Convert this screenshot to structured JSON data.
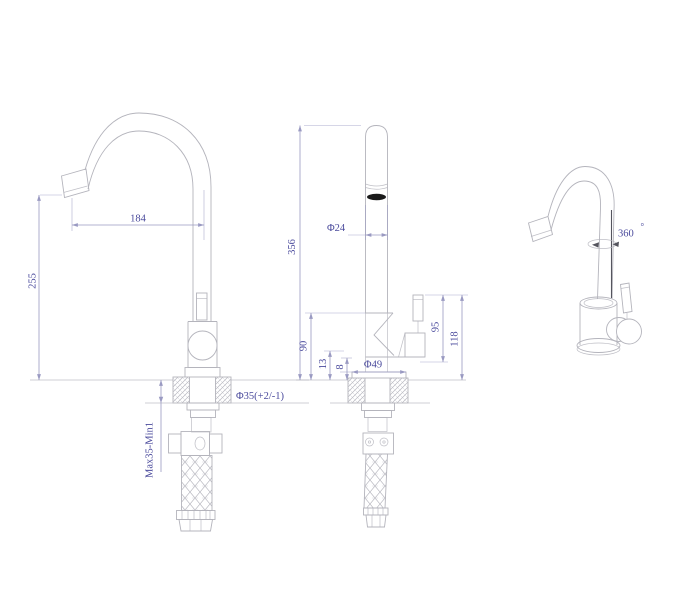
{
  "colors": {
    "background": "#ffffff",
    "geometry_line": "#b4b4bc",
    "dimension_line": "#9a9ac2",
    "dimension_text": "#4a4a9c",
    "dark_accent": "#55555e",
    "aerator_fill": "#1a1a1a"
  },
  "views": {
    "side_view": {
      "dimensions": {
        "spout_reach": "184",
        "spout_height": "255",
        "mounting_thickness_range": "Max35-Min1",
        "hole_diameter": "Φ35(+2/-1)"
      }
    },
    "front_view": {
      "dimensions": {
        "overall_height": "356",
        "spout_tube_diameter": "Φ24",
        "body_height": "90",
        "dim_13": "13",
        "dim_8": "8",
        "base_diameter": "Φ49",
        "handle_height_95": "95",
        "handle_height_118": "118"
      }
    },
    "perspective_view": {
      "dimensions": {
        "swivel_angle": "360",
        "degree_symbol": "°"
      }
    }
  }
}
